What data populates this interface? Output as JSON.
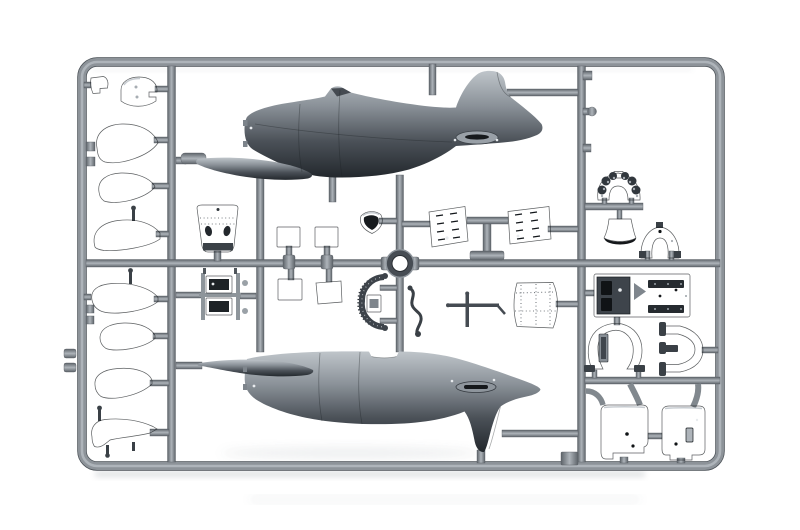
{
  "scene": {
    "type": "photograph",
    "subject": "Injection-moulded grey styrene model aircraft kit sprue (parts runner) photographed on a white background",
    "orientation": "landscape",
    "sprue_material": "dark grey styrene"
  },
  "colors": {
    "background": "#ffffff",
    "runner_light": "#aeb4ba",
    "runner_mid": "#8d9399",
    "runner_dark": "#5e646a",
    "runner_edge": "#4a5056",
    "part_dark_hi": "#5c636a",
    "part_dark": "#3a4046",
    "part_dark_lo": "#22272c",
    "part_black": "#101316",
    "metal_hi": "#bfc5ca",
    "metal_mid": "#8a9198",
    "metal_lo": "#4b5158",
    "metal_deep": "#23282d",
    "highlight_dot": "#e8ebee",
    "shadow": "#b6bbc0"
  },
  "frame": {
    "shape": "rounded rectangle runner frame with one left vertical bar, one right vertical bar, a short centre vertical bar, a full-width horizontal mid bar and short secondary bars"
  },
  "parts": [
    {
      "id": "fuselage-half-upper",
      "desc": "Fuselage half, side profile, nose left, fin up, with wing-root fairing sliver",
      "area": "top centre"
    },
    {
      "id": "fuselage-half-lower",
      "desc": "Fuselage half, side profile, nose left, fin down, exhaust fairing near tail",
      "area": "bottom centre"
    },
    {
      "id": "clip-bracket",
      "desc": "Small notched bracket",
      "area": "top left"
    },
    {
      "id": "cowl-flap-segment",
      "desc": "Rounded cowl segment with notch and pin marks",
      "area": "top left"
    },
    {
      "id": "wheel-spat-1",
      "desc": "Teardrop fairing",
      "area": "left column"
    },
    {
      "id": "wheel-spat-2",
      "desc": "Teardrop fairing",
      "area": "left column"
    },
    {
      "id": "strut-fairing",
      "desc": "Long fairing with mast pin",
      "area": "left column"
    },
    {
      "id": "wheel-spat-3",
      "desc": "Teardrop fairing with pin",
      "area": "left column lower"
    },
    {
      "id": "wheel-spat-4",
      "desc": "Teardrop fairing",
      "area": "left column lower"
    },
    {
      "id": "wheel-spat-5",
      "desc": "Teardrop fairing",
      "area": "left column lower"
    },
    {
      "id": "tail-fairing-boot",
      "desc": "Curved comma-shaped fairing with pins",
      "area": "bottom left"
    },
    {
      "id": "cowling-nose-cone",
      "desc": "Tapered cowling cap, two oval openings, riveted, dark base band",
      "area": "centre left"
    },
    {
      "id": "radiator-block",
      "desc": "Twin-core radiator block in rails with knobs",
      "area": "centre left lower"
    },
    {
      "id": "access-panel-dark-1",
      "desc": "Small dark square panel",
      "area": "centre"
    },
    {
      "id": "access-panel-dark-2",
      "desc": "Small dark square panel",
      "area": "centre"
    },
    {
      "id": "hatch-panel-light-1",
      "desc": "Small light square panel",
      "area": "centre lower"
    },
    {
      "id": "hatch-panel-light-2",
      "desc": "Small light square panel, tilted",
      "area": "centre lower"
    },
    {
      "id": "intake-scoop",
      "desc": "Shield-shaped intake scoop",
      "area": "centre"
    },
    {
      "id": "cowl-ring",
      "desc": "Circular ring",
      "area": "dead centre"
    },
    {
      "id": "cowl-flap-arc",
      "desc": "C-shaped perforated arc with actuator box and end knobs",
      "area": "centre lower"
    },
    {
      "id": "control-rod",
      "desc": "S-bent thin rod with ball ends",
      "area": "centre lower"
    },
    {
      "id": "strut-cross",
      "desc": "Thin crossed rods",
      "area": "centre lower right"
    },
    {
      "id": "louvered-panel-left",
      "desc": "Tilted louvered engine panel",
      "area": "centre right"
    },
    {
      "id": "louvered-panel-right",
      "desc": "Tilted louvered engine panel",
      "area": "centre right"
    },
    {
      "id": "curved-cowl-wrap",
      "desc": "Curved riveted cowling wrap panel",
      "area": "centre right lower"
    },
    {
      "id": "instrument-panel",
      "desc": "Arched instrument panel with dial bumps and top notch",
      "area": "right column"
    },
    {
      "id": "headrest-bell",
      "desc": "Bell/trapezoid headrest with lip",
      "area": "right column"
    },
    {
      "id": "fuselage-former",
      "desc": "Smooth horseshoe former with top tab",
      "area": "right column"
    },
    {
      "id": "cockpit-floor",
      "desc": "Rectangular cockpit floor plate with slots, chevron and rivets",
      "area": "right column middle"
    },
    {
      "id": "engine-mount-ring",
      "desc": "Omega-shaped mount ring with feet and inner strap",
      "area": "right column middle"
    },
    {
      "id": "engine-mount-bracket",
      "desc": "C-shaped mount bracket opening left",
      "area": "right column middle"
    },
    {
      "id": "cowling-half-left",
      "desc": "Large cowling half with stepped base and pin holes",
      "area": "bottom right"
    },
    {
      "id": "cowling-half-right",
      "desc": "Large cowling half with slot opening",
      "area": "bottom right"
    }
  ]
}
